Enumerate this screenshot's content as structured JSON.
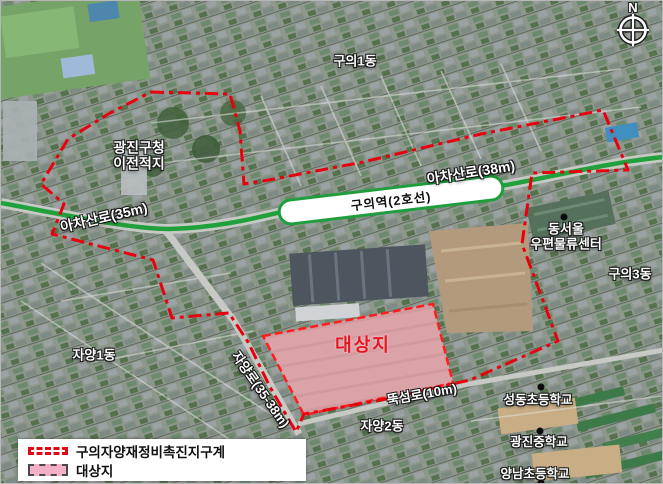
{
  "compass": {
    "label": "N",
    "icon": "compass-rose-icon"
  },
  "map_labels": {
    "guui1dong": "구의1동",
    "gwangjin_office_line1": "광진구청",
    "gwangjin_office_line2": "이전적지",
    "achasanro_35": "아차산로(35m)",
    "station": "구의역(2호선)",
    "achasanro_38": "아차산로(38m)",
    "post_center_line1": "동서울",
    "post_center_line2": "우편물류센터",
    "guui3dong": "구의3동",
    "jayang1dong": "자양1동",
    "jayangro": "자양로(35-38m)",
    "target_site": "대상지",
    "ttukseomro": "뚝섬로(10m)",
    "jayang2dong": "자양2동",
    "seongdong_elementary": "성동초등학교",
    "gwangjin_middle": "광진중학교",
    "yangnam_elementary": "양남초등학교"
  },
  "legend": {
    "items": [
      {
        "label": "구의자양재정비촉진지구계",
        "swatch": "red-dashed-boundary-line"
      },
      {
        "label": "대상지",
        "swatch": "pink-dashed-area"
      }
    ]
  },
  "markers": [
    {
      "name": "dongseoul-post-center",
      "shape": "black-dot"
    },
    {
      "name": "seongdong-elementary",
      "shape": "black-dot"
    },
    {
      "name": "gwangjin-middle-school",
      "shape": "black-dot"
    },
    {
      "name": "yangnam-elementary",
      "shape": "black-dot"
    }
  ],
  "colors": {
    "district_boundary": "#e8000f",
    "target_site_fill": "#f2a9bd",
    "target_site_label": "#e8131f",
    "main_road_green": "#21a13b",
    "station_pill_border": "#1f9e3d",
    "label_text": "#ffffff",
    "label_outline": "#151515",
    "legend_background": "#ffffff"
  }
}
